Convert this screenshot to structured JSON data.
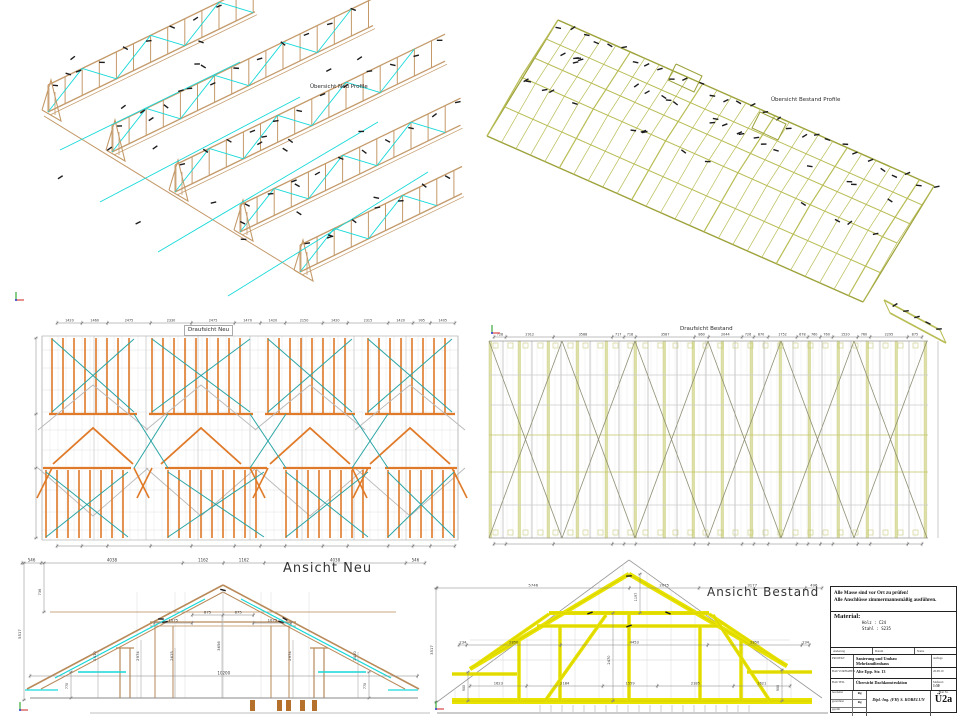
{
  "panels": {
    "iso_neu": {
      "label": "Übersicht Neu Profile"
    },
    "iso_bestand": {
      "label": "Übersicht Bestand Profile"
    },
    "plan_neu": {
      "label": "Draufsicht Neu",
      "top_dims": [
        "1420",
        "1460",
        "2475",
        "2330",
        "2475",
        "1470",
        "1420",
        "2150",
        "1420",
        "2315",
        "1420",
        "995",
        "1405"
      ]
    },
    "plan_bestand": {
      "label": "Draufsicht Bestand",
      "top_dims": [
        "728",
        "2912",
        "3588",
        "717",
        "718",
        "3587",
        "860",
        "2044",
        "726",
        "870",
        "1752",
        "678",
        "760",
        "760",
        "1520",
        "760",
        "2295",
        "875"
      ]
    },
    "ansicht_neu": {
      "label": "Ansicht Neu",
      "top_dims": [
        "546",
        "4038",
        "1162",
        "1162",
        "4038",
        "546"
      ],
      "left_height": "5517",
      "left_upper": "736",
      "collar_left": [
        "1075"
      ],
      "collar_mid": [
        "875",
        "875"
      ],
      "collar_right": [
        "1075"
      ],
      "height_dims": [
        "2410",
        "2974",
        "2615",
        "3656",
        "2974",
        "2410"
      ],
      "span_dim": [
        "10200"
      ],
      "eave_dims": [
        "770",
        "770"
      ]
    },
    "ansicht_bestand": {
      "label": "Ansicht Bestand",
      "top_dims": [
        "5746",
        "2075",
        "3177",
        "496"
      ],
      "apex_dim": "1197",
      "left_height": "3517",
      "mid_dims": [
        "234",
        "2850",
        "4453",
        "2850",
        "234"
      ],
      "post_dims": [
        "1623",
        "2184",
        "1559",
        "2185",
        "1621"
      ],
      "eave_dims": [
        "900",
        "900"
      ],
      "height_dim": "2470"
    }
  },
  "titleblock": {
    "note1": "Alle Masse sind vor Ort zu prüfen!",
    "note2": "Alle Anschlüsse zimmermannsmäßig ausführen.",
    "material_label": "Material:",
    "material_rows": [
      "Holz : C24",
      "Stahl : S235"
    ],
    "rev_cols": [
      "Änderung",
      "Datum",
      "Name"
    ],
    "projekt_label": "PROJEKT",
    "projekt_value": "Sanierung und Umbau Mehrfamilienhaus",
    "bauvorhaben_label": "BAUVORHABEN",
    "bauvorhaben_value": "Alte Epp. Str. 13",
    "bauteil_label": "BAUTEIL",
    "bauteil_value": "Übersicht Dachkonstruktion",
    "auflage_label": "Auflage",
    "auflage_value": "26.08.19",
    "massstab_label": "Maßstab",
    "massstab_value": "1:50",
    "sign_rows": [
      {
        "label": "bearbeitet",
        "value": "Rg"
      },
      {
        "label": "gezeichnet",
        "value": "Rg"
      },
      {
        "label": "geprüft",
        "value": ""
      }
    ],
    "firm": "Dipl.-Ing. (FH) S. KOBELUN",
    "blatt_label": "Blatt Nr.",
    "blatt_value": "Ü2a"
  },
  "colors": {
    "wood_tan": "#c49a6a",
    "new_orange": "#e07a28",
    "new_cyan": "#17d9d9",
    "teal_brace": "#2ba5a5",
    "existing_olive": "#b9bd55",
    "existing_yellow": "#e8e200",
    "dim_gray": "#808080",
    "bolt_black": "#1c1c1c"
  }
}
